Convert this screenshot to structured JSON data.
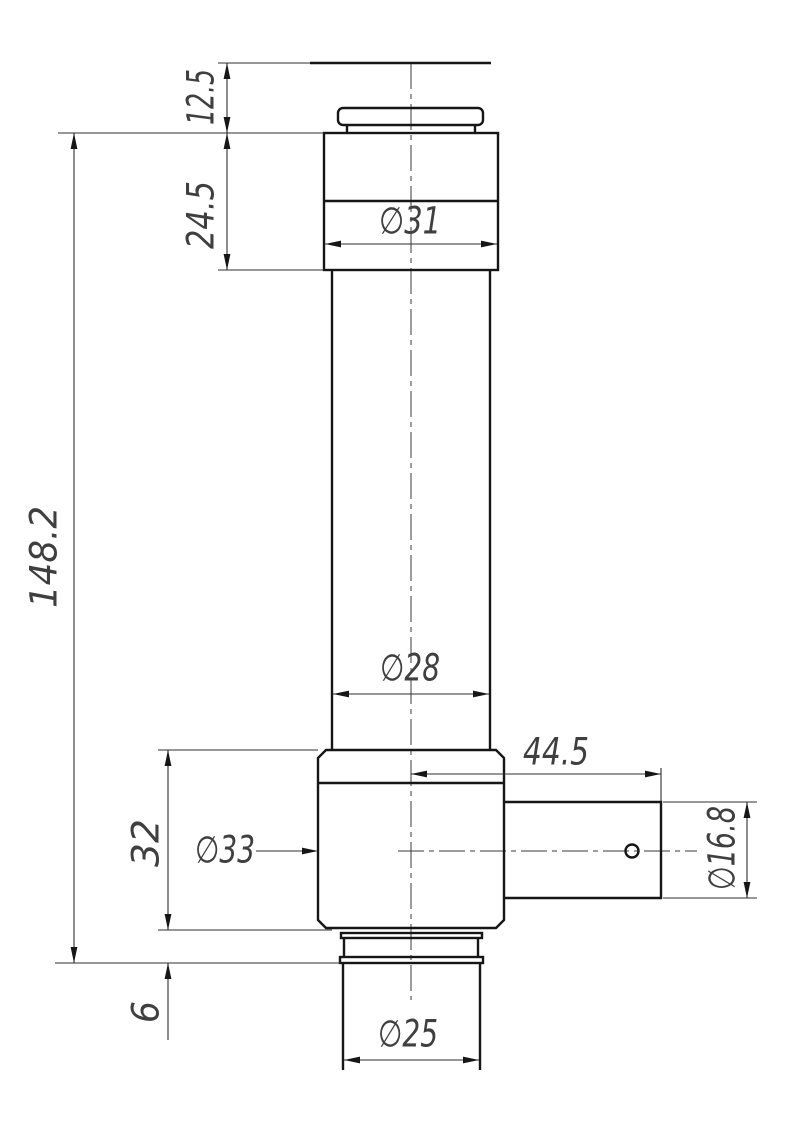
{
  "drawing": {
    "dims": {
      "top_step_height": "12.5",
      "head_height": "24.5",
      "head_diameter": "∅31",
      "overall_height": "148.2",
      "body_diameter": "∅28",
      "side_boss_length": "44.5",
      "hub_height": "32",
      "hub_diameter": "∅33",
      "side_boss_diameter": "∅16.8",
      "flange_height": "6",
      "tail_diameter": "∅25"
    },
    "colors": {
      "background": "#ffffff",
      "outline": "#161616",
      "dimension_lines": "#2f2f2f",
      "dimension_text": "#3f3f3f"
    }
  }
}
